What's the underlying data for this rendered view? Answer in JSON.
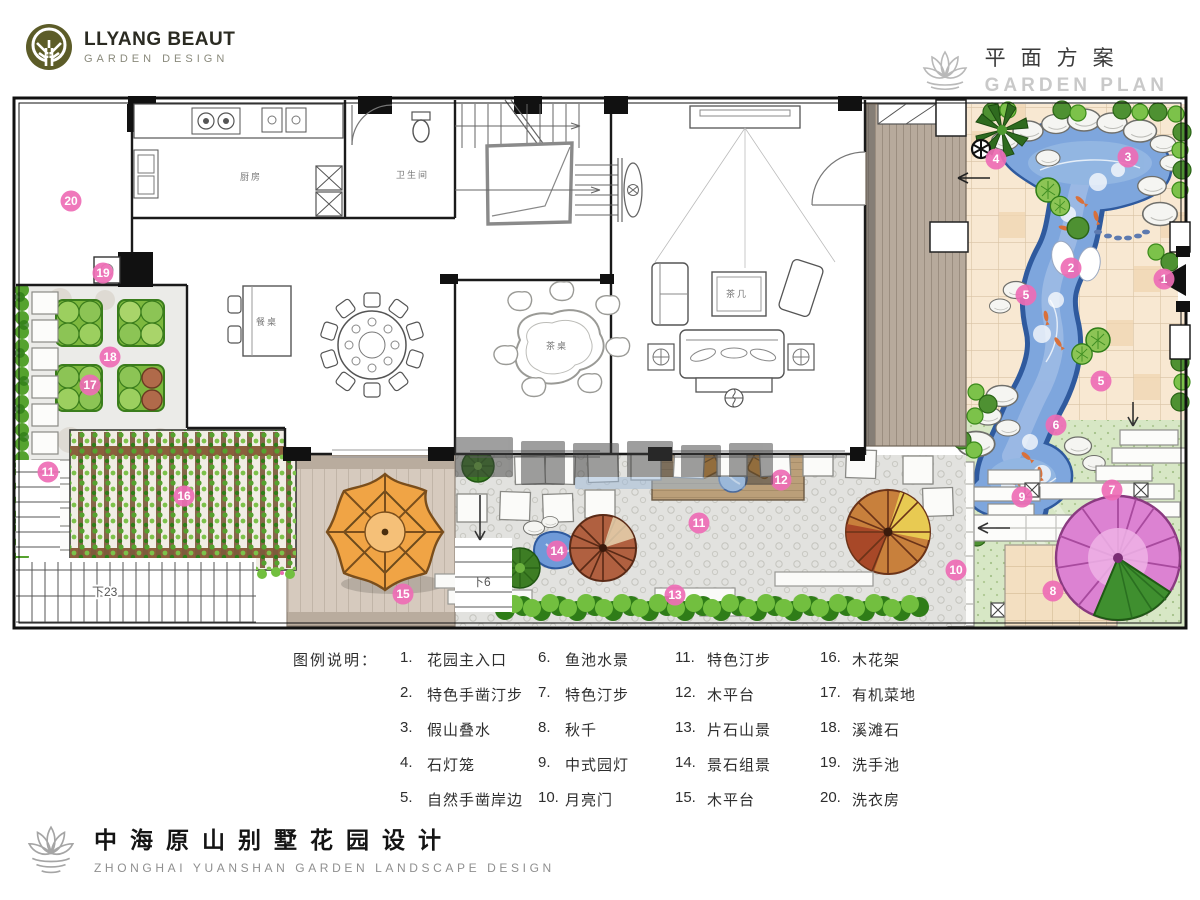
{
  "logo": {
    "name": "LLYANG BEAUT",
    "tagline": "GARDEN DESIGN"
  },
  "plan_header": {
    "title_cn": "平面方案",
    "title_en": "GARDEN PLAN"
  },
  "footer": {
    "title_cn": "中海原山别墅花园设计",
    "title_en": "ZHONGHAI YUANSHAN GARDEN LANDSCAPE DESIGN"
  },
  "legend": {
    "title": "图例说明：",
    "items": [
      {
        "num": "1.",
        "label": "花园主入口"
      },
      {
        "num": "2.",
        "label": "特色手凿汀步"
      },
      {
        "num": "3.",
        "label": "假山叠水"
      },
      {
        "num": "4.",
        "label": "石灯笼"
      },
      {
        "num": "5.",
        "label": "自然手凿岸边"
      },
      {
        "num": "6.",
        "label": "鱼池水景"
      },
      {
        "num": "7.",
        "label": "特色汀步"
      },
      {
        "num": "8.",
        "label": "秋千"
      },
      {
        "num": "9.",
        "label": "中式园灯"
      },
      {
        "num": "10.",
        "label": "月亮门"
      },
      {
        "num": "11.",
        "label": "特色汀步"
      },
      {
        "num": "12.",
        "label": "木平台"
      },
      {
        "num": "13.",
        "label": "片石山景"
      },
      {
        "num": "14.",
        "label": "景石组景"
      },
      {
        "num": "15.",
        "label": "木平台"
      },
      {
        "num": "16.",
        "label": "木花架"
      },
      {
        "num": "17.",
        "label": "有机菜地"
      },
      {
        "num": "18.",
        "label": "溪滩石"
      },
      {
        "num": "19.",
        "label": "洗手池"
      },
      {
        "num": "20.",
        "label": "洗衣房"
      }
    ]
  },
  "plan": {
    "rooms": {
      "kitchen": "厨房",
      "bath": "卫生间",
      "island": "餐桌",
      "tea_table": "茶桌",
      "coffee_table": "茶几"
    },
    "stairs": {
      "left": "下23",
      "mid": "下6"
    },
    "markers": [
      "20",
      "19",
      "18",
      "17",
      "11",
      "16",
      "15",
      "14",
      "13",
      "11",
      "12",
      "10",
      "9",
      "8",
      "7",
      "6",
      "5",
      "5",
      "4",
      "3",
      "2",
      "1"
    ],
    "colors": {
      "marker": "#ee6cb5",
      "pond": "#7ea6dd",
      "lawn": "#d7e7c5",
      "tile": "#f8e8d2",
      "logo_olive": "#5c5c28"
    }
  }
}
